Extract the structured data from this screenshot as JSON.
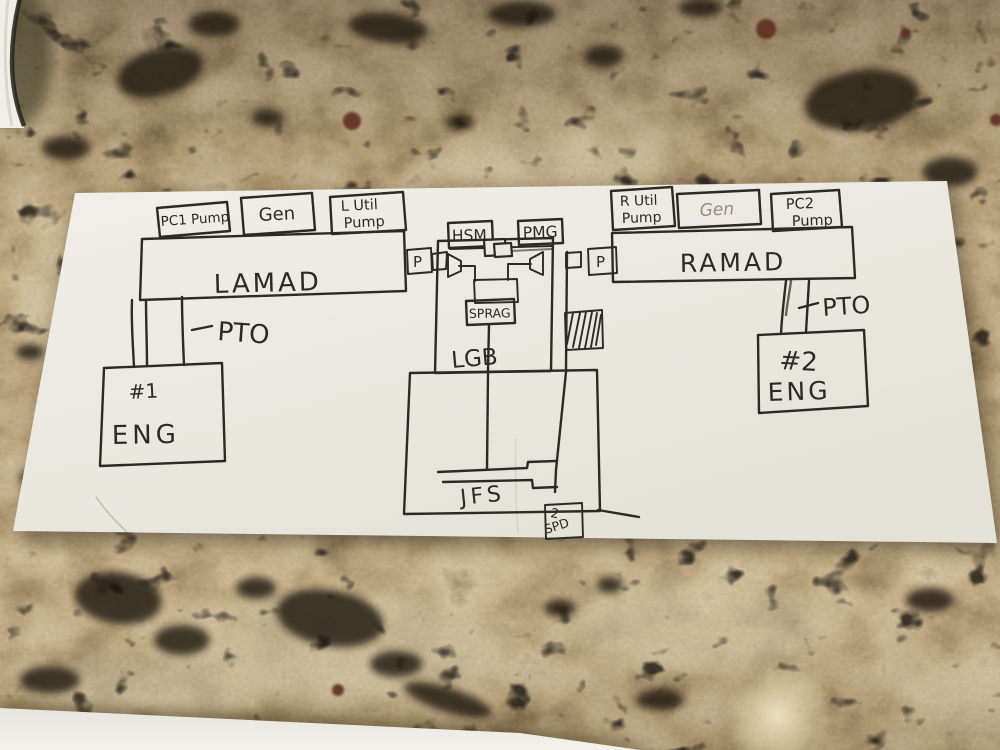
{
  "colors": {
    "ink": "#2d2a23",
    "ink_faint": "#958d7b",
    "paper": "#eae7df",
    "granite_base": "#b1976a"
  },
  "diagram": {
    "left": {
      "accessories": [
        {
          "lines": [
            "PC1 Pump"
          ]
        },
        {
          "lines": [
            "Gen"
          ]
        },
        {
          "lines": [
            "L Util",
            "Pump"
          ]
        }
      ],
      "gearbox_label": "LAMAD",
      "port_label": "P",
      "shaft_label": "PTO",
      "engine": {
        "number": "#1",
        "label": "ENG"
      }
    },
    "center": {
      "top_units": [
        "HSM",
        "PMG"
      ],
      "clutch_label": "SPRAG",
      "gearbox_label": "LGB",
      "starter_label": "JFS",
      "speed_unit": {
        "lines": [
          "2",
          "SPD"
        ]
      }
    },
    "right": {
      "accessories": [
        {
          "lines": [
            "R Util",
            "Pump"
          ]
        },
        {
          "lines": [
            "Gen"
          ]
        },
        {
          "lines": [
            "PC2",
            "Pump"
          ]
        }
      ],
      "gearbox_label": "RAMAD",
      "port_label": "P",
      "shaft_label": "PTO",
      "engine": {
        "number": "#2",
        "label": "ENG"
      }
    }
  }
}
